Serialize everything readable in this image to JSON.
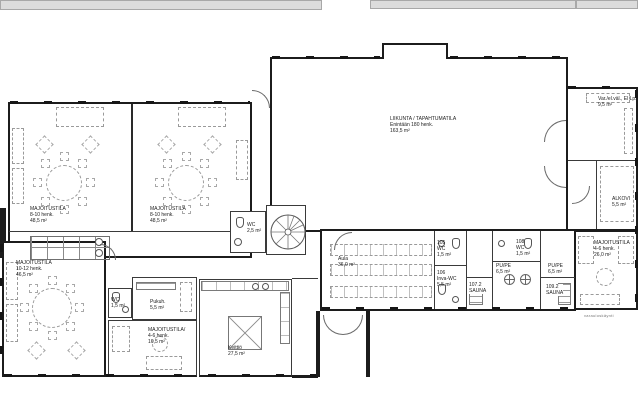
{
  "drawing": {
    "background": "#ffffff",
    "wall_color": "#1c1c1c",
    "line_color": "#3a3a3a",
    "furniture_color": "#9a9a9a",
    "deck_color": "#dcdcdc"
  },
  "rooms": {
    "hall": {
      "name": "LIIKUNTA / TAPAHTUMATILA",
      "capacity": "Enintään 180 henk.",
      "area": "163,5 m²"
    },
    "maj1": {
      "name": "MAJOITUSTILA",
      "capacity": "8-10 henk.",
      "area": "48,5 m²"
    },
    "maj2": {
      "name": "MAJOITUSTILA",
      "capacity": "8-10 henk.",
      "area": "48,5 m²"
    },
    "maj3": {
      "name": "MAJOITUSTILA",
      "capacity": "10-12 henk.",
      "area": "46,5 m²"
    },
    "maj4": {
      "name": "MAJOITUSTILA/",
      "capacity": "4-6 henk.",
      "area": "16,5 m²"
    },
    "maj5": {
      "name": "MAJOITUSTILA",
      "capacity": "4-6 henk.",
      "area": "26,0 m²"
    },
    "aula": {
      "name": "Aula",
      "area": "36,0 m²"
    },
    "keittio": {
      "name": "Keittiö",
      "area": "27,5 m²"
    },
    "pukuh": {
      "name": "Pukuh.",
      "area": "5,5 m²"
    },
    "wc_corridor": {
      "name": "WC",
      "area": "1,5 m²"
    },
    "wc_entry": {
      "name": "WC",
      "area": "2,5 m²"
    },
    "wc105": {
      "num": "105",
      "name": "WC",
      "area": "1,5 m²"
    },
    "wc106": {
      "num": "106",
      "name": "Inva-WC",
      "area": "5,5 m²"
    },
    "sauna107": {
      "num": "107.2",
      "name": "SAUNA",
      "area": "5,5 m²"
    },
    "pupe1": {
      "name": "PU/PE",
      "area": "6,5 m²"
    },
    "wc108": {
      "num": "108",
      "name": "WC",
      "area": "1,5 m²"
    },
    "pupe2": {
      "name": "PU/PE",
      "area": "6,5 m²"
    },
    "sauna109": {
      "num": "109.2",
      "name": "SAUNA",
      "area": "5,5 m²"
    },
    "storage": {
      "name": "Var./el.väl., El Lp.",
      "area": "9,5 m²"
    },
    "alkovi": {
      "name": "ALKOVI",
      "area": "5,5 m²"
    }
  },
  "captions": {
    "exit_note": "varauloskäynti"
  }
}
